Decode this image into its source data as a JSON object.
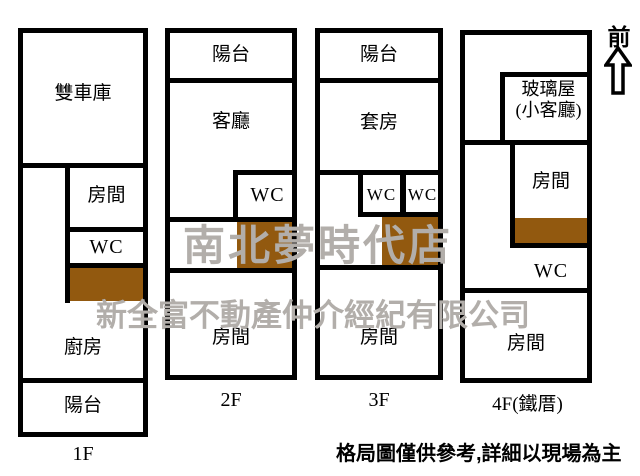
{
  "colors": {
    "background": "#ffffff",
    "wall": "#000000",
    "stairs": "#92590f",
    "watermark": "#b2aeaa"
  },
  "compass": {
    "front_label": "前"
  },
  "watermarks": {
    "store": "南北夢時代店",
    "company": "新全富不動產仲介經紀有限公司"
  },
  "footnote": "格局圖僅供參考,詳細以現場為主",
  "floors": [
    {
      "label": "1F",
      "rooms": {
        "garage": "雙車庫",
        "room": "房間",
        "wc": "WC",
        "kitchen": "廚房",
        "balcony": "陽台"
      }
    },
    {
      "label": "2F",
      "rooms": {
        "balcony": "陽台",
        "living_room": "客廳",
        "wc": "WC",
        "room": "房間"
      }
    },
    {
      "label": "3F",
      "rooms": {
        "balcony": "陽台",
        "suite": "套房",
        "wc_left": "WC",
        "wc_right": "WC",
        "room": "房間"
      }
    },
    {
      "label": "4F(鐵厝)",
      "rooms": {
        "glass_house": "玻璃屋",
        "glass_house_note": "(小客廳)",
        "room_upper": "房間",
        "wc": "WC",
        "room_lower": "房間"
      }
    }
  ]
}
